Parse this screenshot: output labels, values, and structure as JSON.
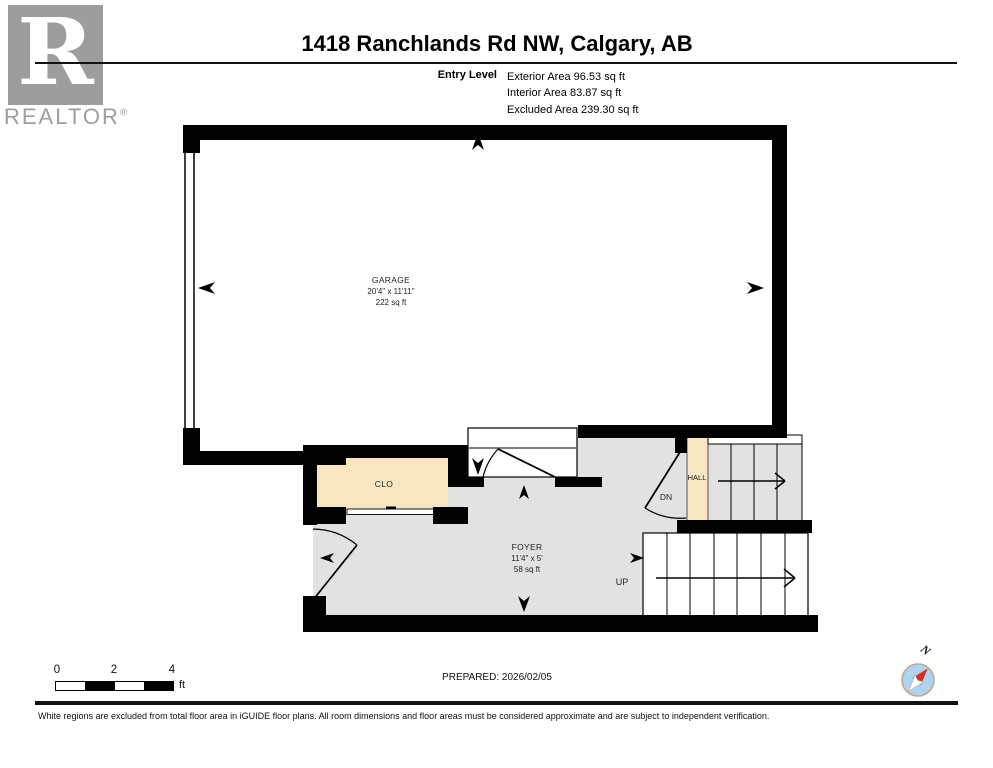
{
  "header": {
    "title": "1418 Ranchlands Rd NW, Calgary, AB",
    "level_label": "Entry Level",
    "area_lines": [
      "Exterior Area 96.53 sq ft",
      "Interior Area 83.87 sq ft",
      "Excluded Area 239.30 sq ft"
    ],
    "logo": {
      "letter": "R",
      "brand": "REALTOR",
      "registered": "®"
    }
  },
  "plan": {
    "rooms": {
      "garage": {
        "name": "GARAGE",
        "dims": "20'4\" x 11'11\"",
        "area": "222 sq ft"
      },
      "clo": {
        "name": "CLO"
      },
      "foyer": {
        "name": "FOYER",
        "dims": "11'4\" x 5'",
        "area": "58 sq ft"
      },
      "hall": {
        "name": "HALL"
      }
    },
    "stairs": {
      "down_label": "DN",
      "up_label": "UP"
    }
  },
  "footer": {
    "scale_ticks": [
      "0",
      "2",
      "4"
    ],
    "scale_unit": "ft",
    "prepared": "PREPARED: 2026/02/05",
    "compass_north": "N",
    "disclaimer": "White regions are excluded from total floor area in iGUIDE floor plans. All room dimensions and floor areas must be considered approximate and are subject to independent verification."
  },
  "colors": {
    "wall": "#000000",
    "floor_gray": "#e2e2e2",
    "room_beige": "#f7e6c1",
    "logo_gray": "#9d9d9d",
    "compass_blue": "#aed3ee",
    "compass_red": "#d32f23"
  }
}
